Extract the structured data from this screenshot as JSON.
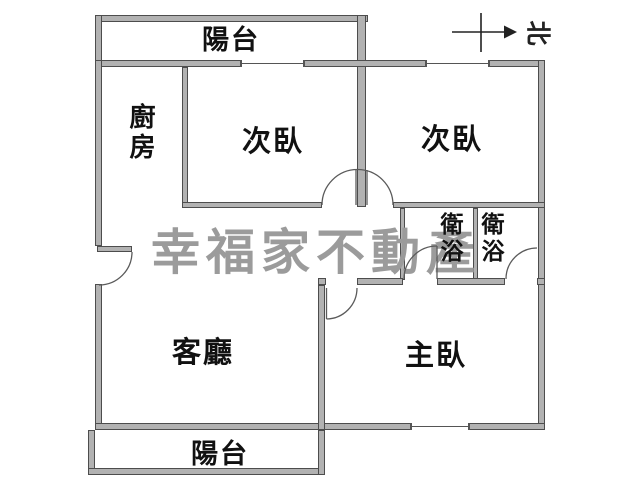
{
  "plan_title": "apartment-floor-plan",
  "watermark": "幸福家不動產",
  "compass": {
    "label": "北",
    "arrow_direction": "right"
  },
  "colors": {
    "wall_fill": "#b2b2b2",
    "wall_edge": "#4d4d4d",
    "label_text": "#111111",
    "watermark_gray": "#9b9b9b",
    "background": "#ffffff"
  },
  "rooms": {
    "balcony_top": {
      "label": "陽台"
    },
    "kitchen": {
      "label": "廚房",
      "orientation": "vertical"
    },
    "bedroom_left": {
      "label": "次臥"
    },
    "bedroom_right": {
      "label": "次臥"
    },
    "bath_left": {
      "label": "衛浴",
      "orientation": "vertical"
    },
    "bath_right": {
      "label": "衛浴",
      "orientation": "vertical"
    },
    "living": {
      "label": "客廳"
    },
    "master": {
      "label": "主臥"
    },
    "balcony_bottom": {
      "label": "陽台"
    }
  }
}
